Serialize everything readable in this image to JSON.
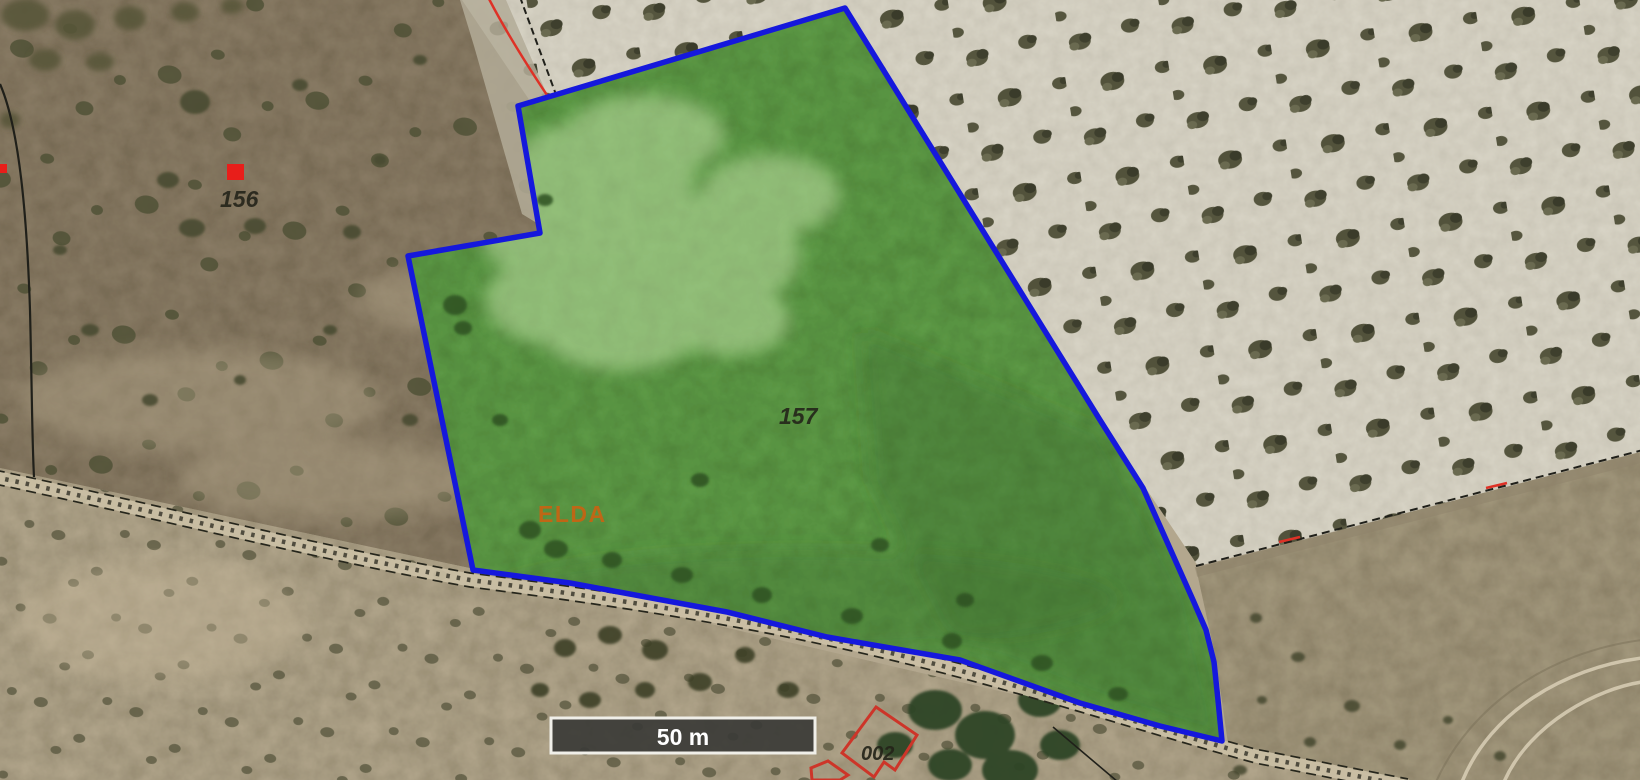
{
  "labels": {
    "adjacent_parcel": "156",
    "main_parcel": "157",
    "zone": "ELDA",
    "building": "002"
  },
  "scale_bar": {
    "label": "50 m"
  },
  "colors": {
    "parcel_fill": "#5f9e48",
    "parcel_border": "#1518dc",
    "building_outline": "#cd3529",
    "red_boundary_line": "#de3126",
    "zone_label": "#d2600f",
    "parcel_label": "#24241a",
    "scalebar_fill": "#3b3b37",
    "scalebar_text": "#ffffff",
    "marker_red": "#e81e1a"
  }
}
